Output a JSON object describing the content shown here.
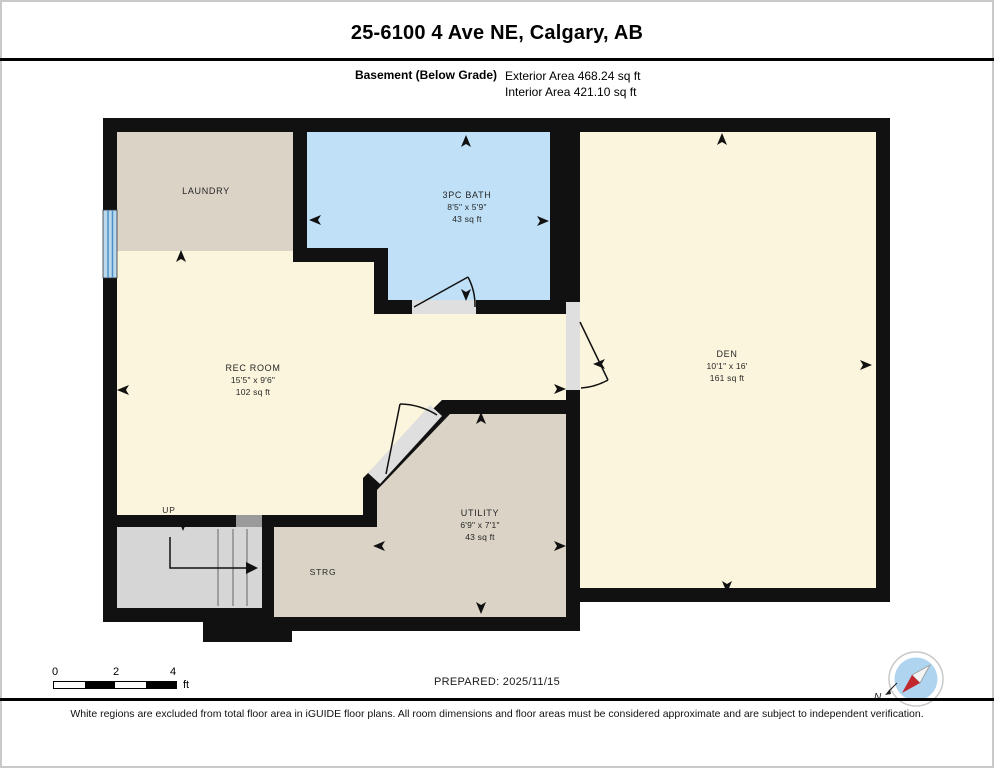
{
  "header": {
    "title": "25-6100 4 Ave NE, Calgary, AB",
    "floor_label": "Basement (Below Grade)",
    "exterior_area": "Exterior Area 468.24 sq ft",
    "interior_area": "Interior Area 421.10 sq ft"
  },
  "rooms": {
    "laundry": {
      "name": "LAUNDRY"
    },
    "bath": {
      "name": "3PC BATH",
      "dims": "8'5\" x 5'9\"",
      "area": "43 sq ft"
    },
    "rec": {
      "name": "REC ROOM",
      "dims": "15'5\" x 9'6\"",
      "area": "102 sq ft"
    },
    "den": {
      "name": "DEN",
      "dims": "10'1\" x 16'",
      "area": "161 sq ft"
    },
    "utility": {
      "name": "UTILITY",
      "dims": "6'9\" x 7'1\"",
      "area": "43 sq ft"
    },
    "storage": {
      "name": "STRG"
    },
    "stairs": {
      "name": "UP"
    }
  },
  "footer": {
    "scale": {
      "ticks": [
        "0",
        "2",
        "4"
      ],
      "unit": "ft"
    },
    "prepared": "PREPARED: 2025/11/15",
    "compass_label": "N",
    "disclaimer": "White regions are excluded from total floor area in iGUIDE floor plans. All room dimensions and floor areas must be considered approximate and are subject to independent verification."
  },
  "colors": {
    "wall": "#111111",
    "room_cream": "#FBF5DD",
    "room_beige": "#DAD3C6",
    "bath_blue": "#BFE0F7",
    "stairs_gray": "#D6D6D6",
    "door_gray": "#DFDFDF",
    "window_blue": "#4D8FC4",
    "compass_red": "#C1272D"
  }
}
